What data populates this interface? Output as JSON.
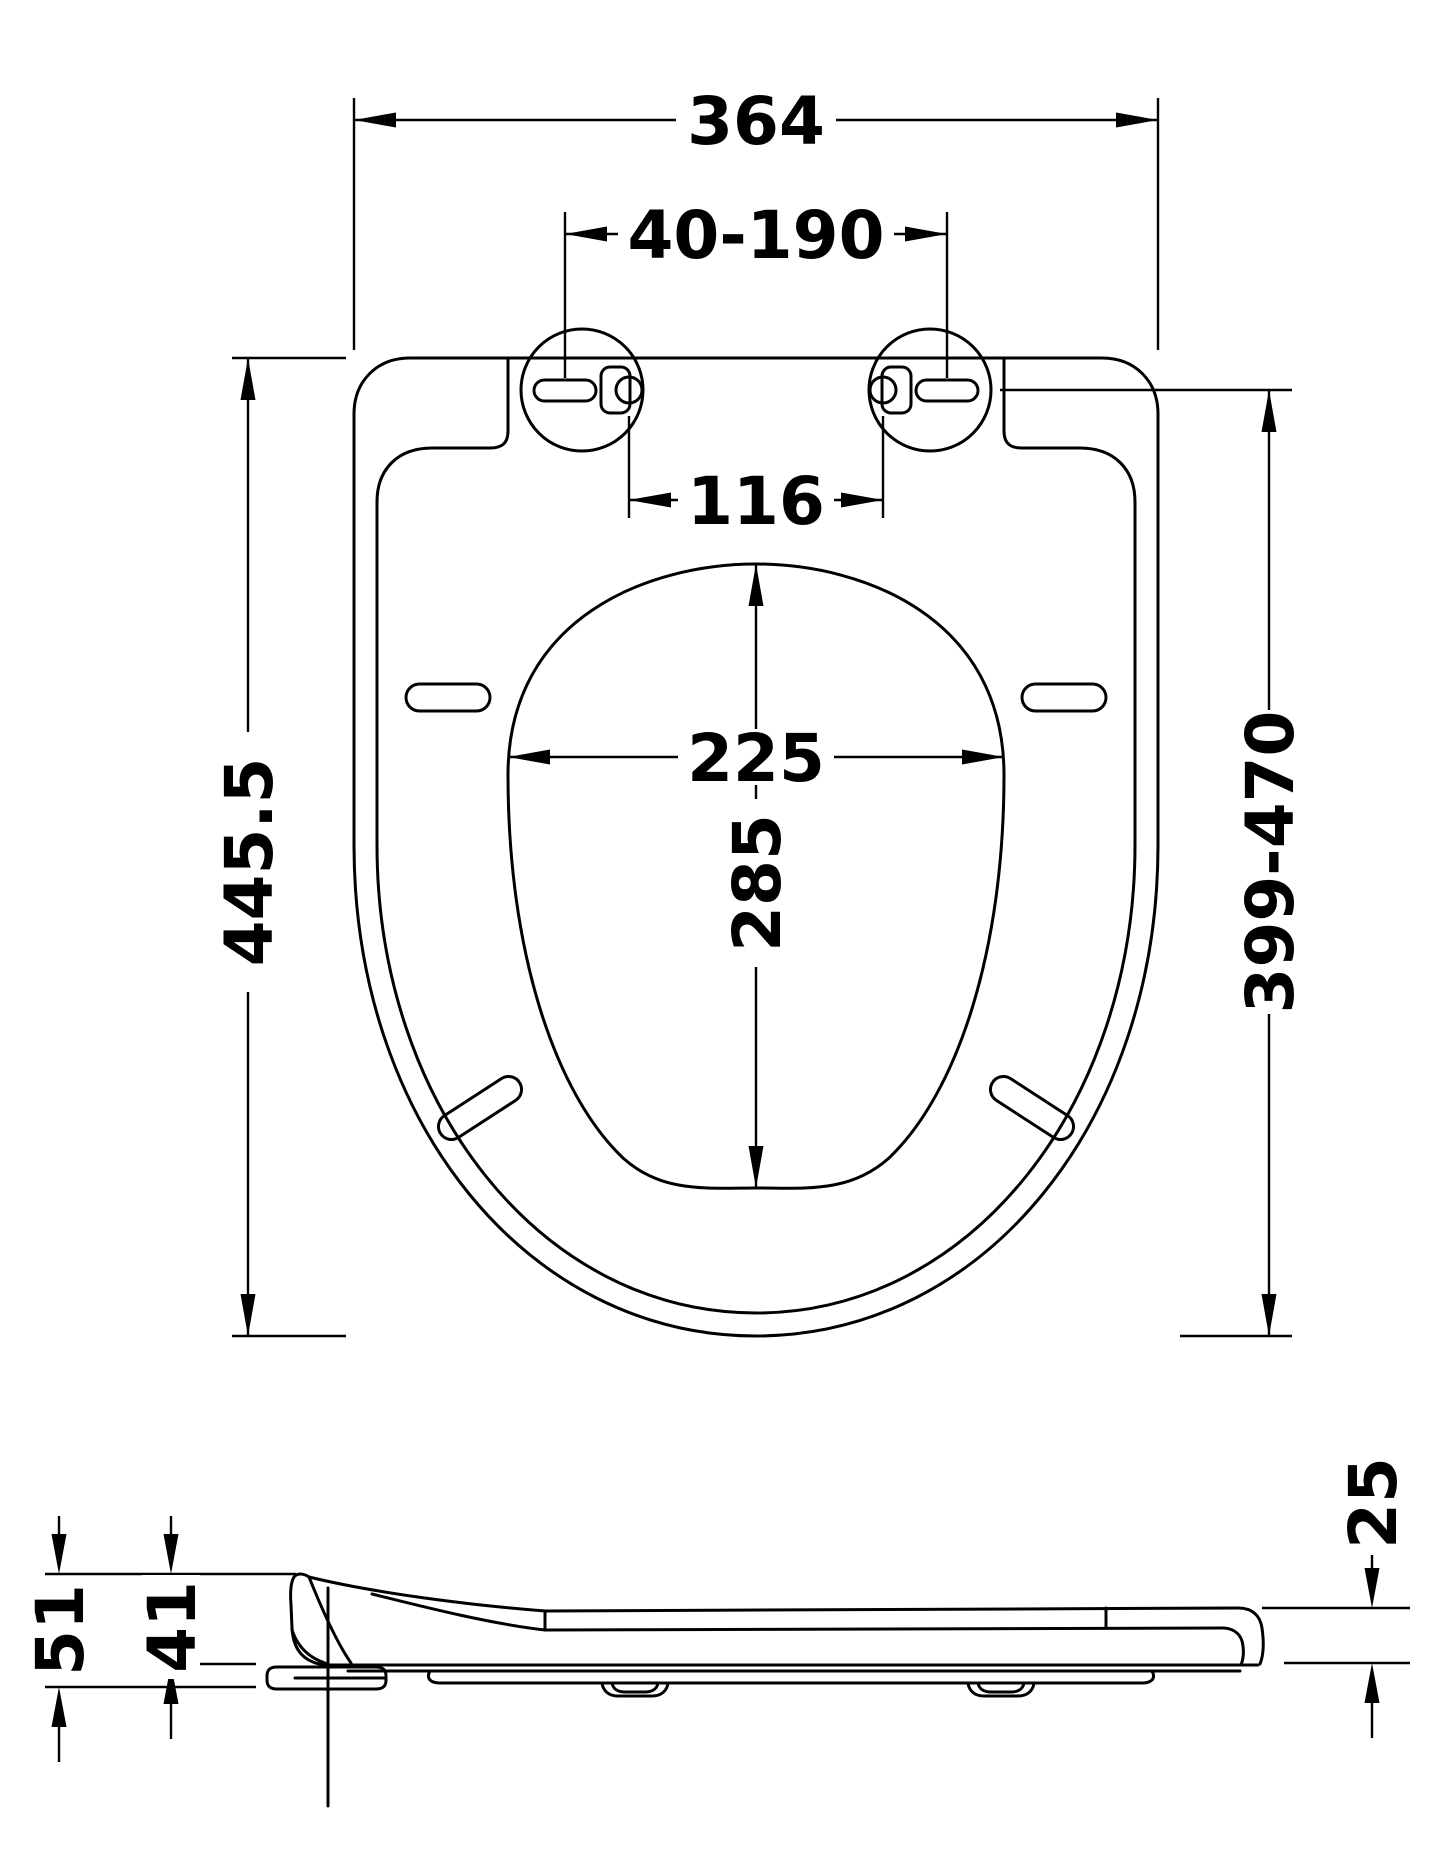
{
  "drawing": {
    "type": "technical-dimension-drawing",
    "subject": "d-shaped toilet seat",
    "background_color": "#ffffff",
    "line_color": "#000000",
    "views": {
      "top": {
        "name": "top-view",
        "dimensions": {
          "overall_width": "364",
          "hinge_adjust_range": "40-190",
          "hinge_hole_spacing": "116",
          "bowl_opening_width": "225",
          "bowl_opening_length": "285",
          "overall_length": "445.5",
          "hinge_to_front_range": "399-470"
        }
      },
      "side": {
        "name": "side-view",
        "dimensions": {
          "overall_height_front": "51",
          "seat_height_front": "41",
          "seat_thickness_rear": "25"
        }
      }
    }
  }
}
